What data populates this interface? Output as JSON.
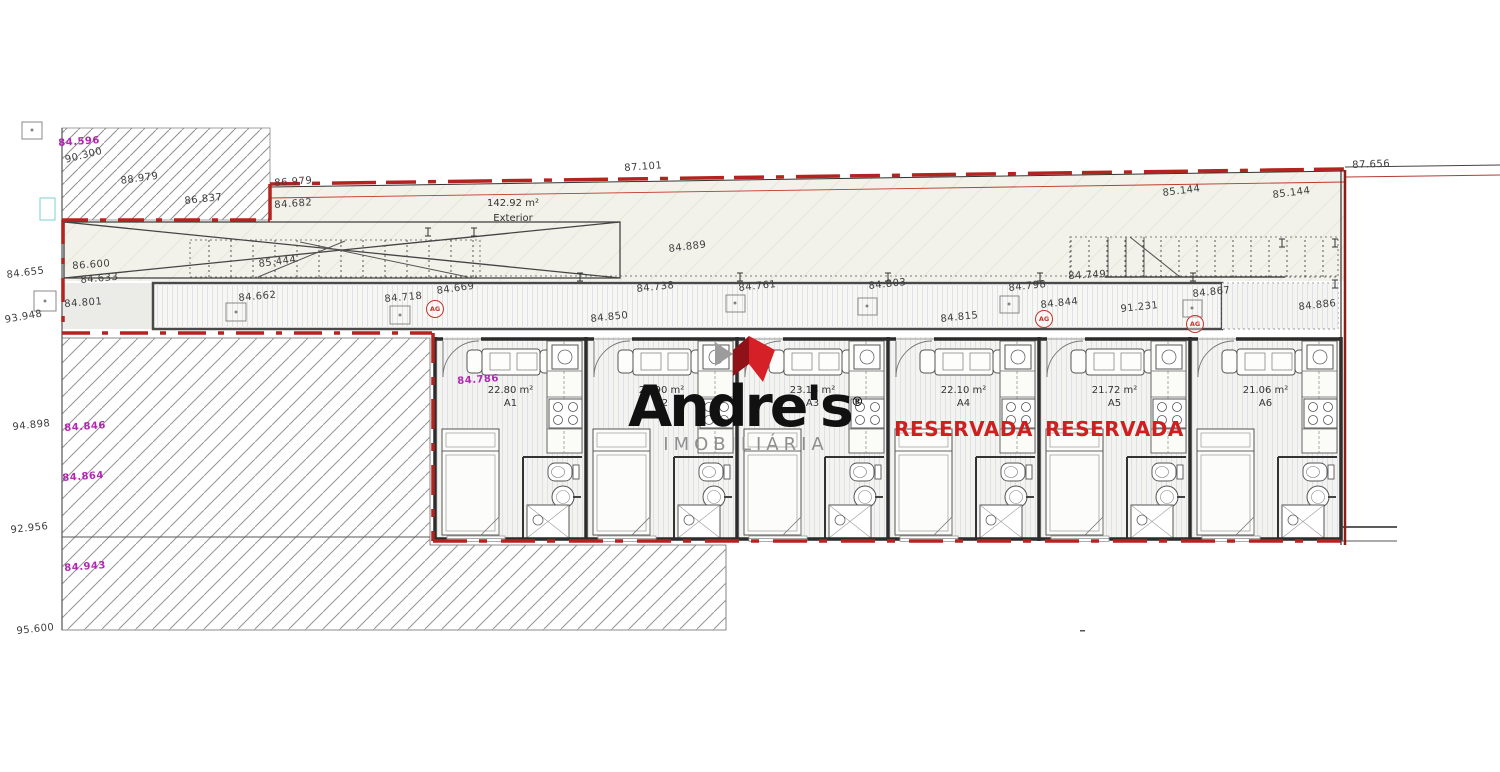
{
  "logo": {
    "name": "Andre's",
    "registered": "®",
    "subtitle": "IMOBILIÁRIA"
  },
  "exterior": {
    "area": "142.92 m²",
    "label": "Exterior"
  },
  "reserved_label": "RESERVADA",
  "units": [
    {
      "id": "A1",
      "area": "22.80 m²",
      "reserved": false
    },
    {
      "id": "A2",
      "area": "23.90 m²",
      "reserved": false
    },
    {
      "id": "A3",
      "area": "23.18 m²",
      "reserved": false
    },
    {
      "id": "A4",
      "area": "22.10 m²",
      "reserved": true
    },
    {
      "id": "A5",
      "area": "21.72 m²",
      "reserved": true
    },
    {
      "id": "A6",
      "area": "21.06 m²",
      "reserved": false
    }
  ],
  "ag_markers": [
    {
      "text": "AG",
      "x": 426,
      "y": 300
    },
    {
      "text": "AG",
      "x": 1035,
      "y": 310
    },
    {
      "text": "AG",
      "x": 1186,
      "y": 315
    }
  ],
  "plan_labels": [
    {
      "text": "90.300",
      "x": 64,
      "y": 155,
      "rot": -14,
      "color": "black"
    },
    {
      "text": "88.979",
      "x": 120,
      "y": 176,
      "rot": -8,
      "color": "black"
    },
    {
      "text": "86.837",
      "x": 184,
      "y": 196,
      "rot": -6,
      "color": "black"
    },
    {
      "text": "86.979",
      "x": 274,
      "y": 178,
      "rot": -4,
      "color": "black"
    },
    {
      "text": "84.682",
      "x": 274,
      "y": 200,
      "rot": -4,
      "color": "black"
    },
    {
      "text": "87.101",
      "x": 624,
      "y": 163,
      "rot": -4,
      "color": "black"
    },
    {
      "text": "87.656",
      "x": 1352,
      "y": 160,
      "rot": -2,
      "color": "black"
    },
    {
      "text": "85.144",
      "x": 1162,
      "y": 188,
      "rot": -7,
      "color": "black"
    },
    {
      "text": "85.144",
      "x": 1272,
      "y": 190,
      "rot": -7,
      "color": "black"
    },
    {
      "text": "84.889",
      "x": 668,
      "y": 244,
      "rot": -7,
      "color": "black"
    },
    {
      "text": "86.600",
      "x": 72,
      "y": 261,
      "rot": -4,
      "color": "black"
    },
    {
      "text": "84.633",
      "x": 80,
      "y": 275,
      "rot": -5,
      "color": "black"
    },
    {
      "text": "85.444",
      "x": 258,
      "y": 259,
      "rot": -7,
      "color": "black"
    },
    {
      "text": "84.655",
      "x": 6,
      "y": 270,
      "rot": -7,
      "color": "black"
    },
    {
      "text": "84.801",
      "x": 64,
      "y": 299,
      "rot": -4,
      "color": "black"
    },
    {
      "text": "84.662",
      "x": 238,
      "y": 293,
      "rot": -5,
      "color": "black"
    },
    {
      "text": "84.718",
      "x": 384,
      "y": 294,
      "rot": -5,
      "color": "black"
    },
    {
      "text": "84.669",
      "x": 436,
      "y": 286,
      "rot": -8,
      "color": "black"
    },
    {
      "text": "84.738",
      "x": 636,
      "y": 284,
      "rot": -6,
      "color": "black"
    },
    {
      "text": "84.761",
      "x": 738,
      "y": 283,
      "rot": -6,
      "color": "black"
    },
    {
      "text": "84.850",
      "x": 590,
      "y": 314,
      "rot": -6,
      "color": "black"
    },
    {
      "text": "84.803",
      "x": 868,
      "y": 281,
      "rot": -6,
      "color": "black"
    },
    {
      "text": "84.798",
      "x": 1008,
      "y": 283,
      "rot": -6,
      "color": "black"
    },
    {
      "text": "84.749",
      "x": 1068,
      "y": 271,
      "rot": -3,
      "color": "black"
    },
    {
      "text": "84.844",
      "x": 1040,
      "y": 300,
      "rot": -6,
      "color": "black"
    },
    {
      "text": "84.815",
      "x": 940,
      "y": 314,
      "rot": -6,
      "color": "black"
    },
    {
      "text": "91.231",
      "x": 1120,
      "y": 304,
      "rot": -6,
      "color": "black"
    },
    {
      "text": "84.867",
      "x": 1192,
      "y": 289,
      "rot": -6,
      "color": "black"
    },
    {
      "text": "84.886",
      "x": 1298,
      "y": 302,
      "rot": -6,
      "color": "black"
    },
    {
      "text": "93.948",
      "x": 4,
      "y": 315,
      "rot": -10,
      "color": "black"
    },
    {
      "text": "94.898",
      "x": 12,
      "y": 422,
      "rot": -6,
      "color": "black"
    },
    {
      "text": "92.956",
      "x": 10,
      "y": 525,
      "rot": -6,
      "color": "black"
    },
    {
      "text": "95.600",
      "x": 16,
      "y": 626,
      "rot": -6,
      "color": "black"
    },
    {
      "text": "84.596",
      "x": 58,
      "y": 138,
      "rot": -4,
      "color": "purple"
    },
    {
      "text": "84.786",
      "x": 457,
      "y": 376,
      "rot": -4,
      "color": "purple"
    },
    {
      "text": "84.846",
      "x": 64,
      "y": 423,
      "rot": -4,
      "color": "purple"
    },
    {
      "text": "84.864",
      "x": 62,
      "y": 473,
      "rot": -4,
      "color": "purple"
    },
    {
      "text": "84.943",
      "x": 64,
      "y": 563,
      "rot": -4,
      "color": "purple"
    }
  ],
  "colors": {
    "boundary_red": "#b32420",
    "purple": "#b227b2",
    "reserved_red": "#cf1f1f",
    "logo_red": "#d62028",
    "logo_gray": "#8f8f8f"
  }
}
